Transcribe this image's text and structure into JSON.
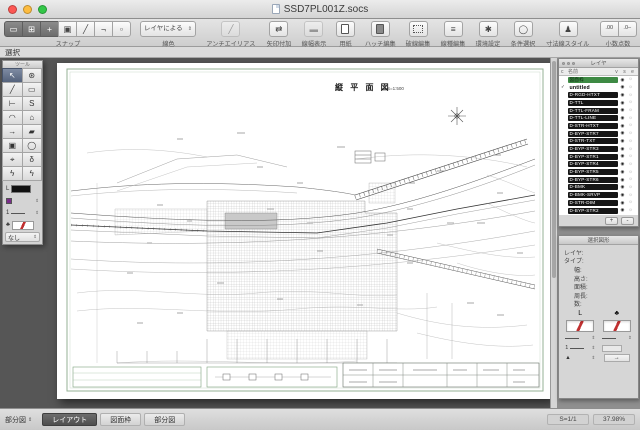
{
  "window": {
    "title": "SSD7PL001Z.socs"
  },
  "mode_label": "選択",
  "toolbar": {
    "snap": {
      "label": "スナップ",
      "segments": [
        {
          "glyph": "▭",
          "active": true
        },
        {
          "glyph": "⊞",
          "active": true
        },
        {
          "glyph": "+",
          "active": true
        },
        {
          "glyph": "▣",
          "active": false
        },
        {
          "glyph": "╱",
          "active": false
        },
        {
          "glyph": "¬",
          "active": false
        },
        {
          "glyph": "▫",
          "active": false
        }
      ]
    },
    "line_color": {
      "value": "レイヤによる",
      "label": "線色"
    },
    "antialias": {
      "label": "アンチエイリアス",
      "glyph": "╱"
    },
    "arrow_add": {
      "label": "矢印付加",
      "glyph": "⇄"
    },
    "line_width_disp": {
      "label": "線幅表示",
      "glyph": "▬"
    },
    "paper": {
      "label": "用紙"
    },
    "hatch_edit": {
      "label": "ハッチ編集"
    },
    "dash_edit": {
      "label": "破線編集"
    },
    "linetype_edit": {
      "label": "線種編集",
      "glyph": "≡"
    },
    "preferences": {
      "label": "環境設定",
      "glyph": "✱"
    },
    "cond_select": {
      "label": "条件選択",
      "glyph": "◯"
    },
    "dim_style": {
      "label": "寸法線スタイル",
      "glyph": "♟"
    },
    "decimals": {
      "label": "小数点数",
      "buttons": [
        ".00",
        ".0‒"
      ]
    },
    "dim_text_pos": {
      "label": "寸法線文字位置",
      "segments": [
        "><",
        "◇",
        "⠿",
        "X",
        "⇕"
      ]
    },
    "shortcut": {
      "label": "ショートカット",
      "glyph": "⊘"
    }
  },
  "tool_palette": {
    "title": "ツール",
    "tools": [
      {
        "name": "select-tool",
        "glyph": "↖",
        "selected": true
      },
      {
        "name": "pan-tool",
        "glyph": "⊛"
      },
      {
        "name": "line-tool",
        "glyph": "╱"
      },
      {
        "name": "rect-tool",
        "glyph": "▭"
      },
      {
        "name": "polyline-tool",
        "glyph": "⊢"
      },
      {
        "name": "spline-tool",
        "glyph": "S"
      },
      {
        "name": "arc-tool",
        "glyph": "◠"
      },
      {
        "name": "polygon-tool",
        "glyph": "⌂"
      },
      {
        "name": "arrow-tool",
        "glyph": "→"
      },
      {
        "name": "eraser-tool",
        "glyph": "▰"
      },
      {
        "name": "image-tool",
        "glyph": "▣"
      },
      {
        "name": "circle-tool",
        "glyph": "◯"
      },
      {
        "name": "rotate-tool",
        "glyph": "⌖"
      },
      {
        "name": "measure-tool",
        "glyph": "δ"
      },
      {
        "name": "zap-tool-1",
        "glyph": "ϟ"
      },
      {
        "name": "zap-tool-2",
        "glyph": "ϟ"
      }
    ],
    "controls": {
      "l_label": "L",
      "width_value": "1",
      "pen_glyph": "♣",
      "none_label": "なし"
    }
  },
  "canvas": {
    "sheet_title": "縦 平 面 図",
    "sheet_scale": "S=1:500"
  },
  "layers_panel": {
    "title": "レイヤ",
    "columns": {
      "c": "c",
      "name": "名前",
      "v": "v",
      "s": "s",
      "e": "e"
    },
    "eye_glyph": "◉",
    "print_glyph": "☼",
    "add_label": "+",
    "remove_label": "-",
    "items": [
      {
        "name": "図面枠",
        "style": "green",
        "check": ""
      },
      {
        "name": "untitled",
        "style": "plain",
        "check": "✓"
      },
      {
        "name": "D-RGD-HTXT",
        "style": "black",
        "check": ""
      },
      {
        "name": "D-TTL",
        "style": "black",
        "check": ""
      },
      {
        "name": "D-TTL-FRAM",
        "style": "black",
        "check": ""
      },
      {
        "name": "D-TTL-LINE",
        "style": "black",
        "check": ""
      },
      {
        "name": "D-STR-HTXT",
        "style": "black",
        "check": ""
      },
      {
        "name": "D-BYP-STR7",
        "style": "black",
        "check": ""
      },
      {
        "name": "D-STR-TXT",
        "style": "black",
        "check": ""
      },
      {
        "name": "D-BYP-STR3",
        "style": "black",
        "check": ""
      },
      {
        "name": "D-BYP-STR1",
        "style": "black",
        "check": ""
      },
      {
        "name": "D-BYP-STR4",
        "style": "black",
        "check": ""
      },
      {
        "name": "D-BYP-STR5",
        "style": "black",
        "check": ""
      },
      {
        "name": "D-BYP-STR6",
        "style": "black",
        "check": ""
      },
      {
        "name": "D-BMK",
        "style": "black",
        "check": ""
      },
      {
        "name": "D-BMK-SRVP",
        "style": "black",
        "check": ""
      },
      {
        "name": "D-STR-DIM",
        "style": "black",
        "check": ""
      },
      {
        "name": "D-BYP-STR2",
        "style": "black",
        "check": ""
      }
    ]
  },
  "info_panel": {
    "title": "選択図形",
    "fields": [
      "レイヤ:",
      "タイプ:",
      "幅:",
      "高さ:",
      "面積:",
      "周長:",
      "数:"
    ],
    "line_col_label": "L",
    "pen_col_label": "♣",
    "width_value": "1",
    "marker_glyph": "▲",
    "arrow_glyph": "→"
  },
  "status_bar": {
    "sheet_selector": "部分図",
    "tabs": [
      {
        "label": "レイアウト",
        "active": true
      },
      {
        "label": "図面枠",
        "active": false
      },
      {
        "label": "部分図",
        "active": false
      }
    ],
    "scale": "S=1/1",
    "zoom": "37.98%"
  }
}
